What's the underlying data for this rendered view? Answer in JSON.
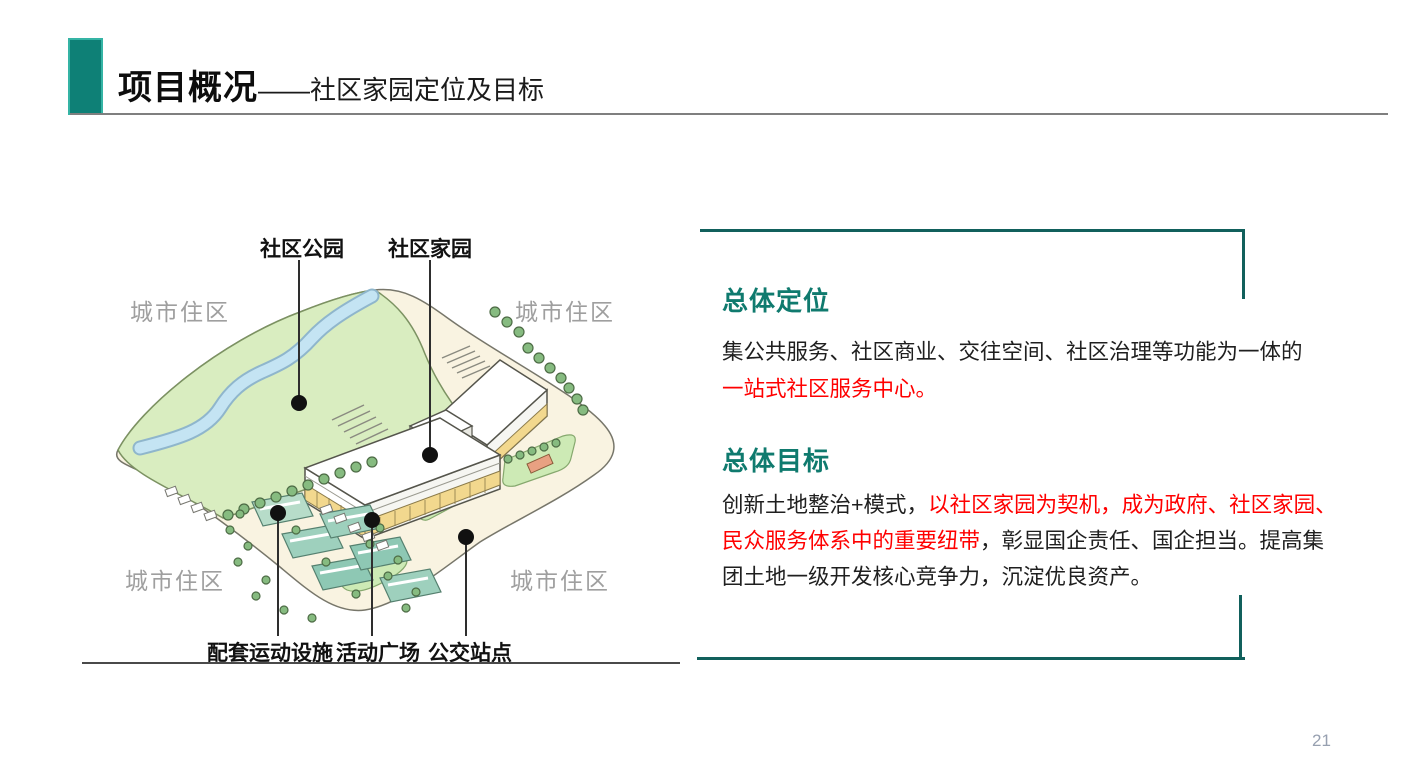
{
  "slide": {
    "page_number": "21",
    "header": {
      "title_main": "项目概况",
      "title_suffix": "——社区家园定位及目标"
    },
    "diagram": {
      "label_community_park": "社区公园",
      "label_community_home": "社区家园",
      "label_urban_residential": "城市住区",
      "label_sports_facility": "配套运动设施",
      "label_activity_plaza": "活动广场",
      "label_bus_stop": "公交站点"
    },
    "panel": {
      "positioning": {
        "heading": "总体定位",
        "lines": [
          {
            "black": "集公共服务、社区商业、交往空间、社区治理等功能为一体的"
          },
          {
            "red": "一站式社区服务中心。"
          }
        ]
      },
      "goal": {
        "heading": "总体目标",
        "lines": [
          {
            "black": "创新土地整治+模式，",
            "red": "以社区家园为契机，成为政府、社区家园、"
          },
          {
            "red": "民众服务体系中的重要纽带",
            "black": "，彰显国企责任、国企担当。提高集"
          },
          {
            "black": "团土地一级开发核心竞争力，沉淀优良资产。"
          }
        ]
      }
    },
    "colors": {
      "accent_teal": "#0E8076",
      "heading_teal": "#0F7A6E",
      "emphasis_red": "#FF0000",
      "border_teal": "#11605C"
    }
  }
}
